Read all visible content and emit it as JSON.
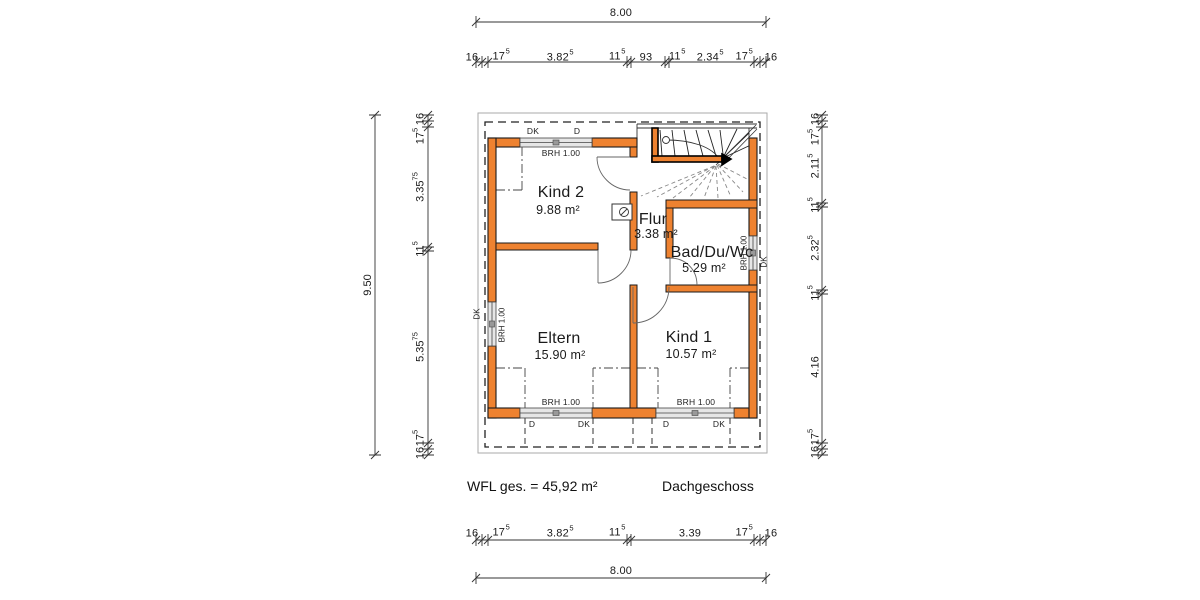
{
  "title": "Dachgeschoss Grundriss",
  "dims": {
    "top_total": "8.00",
    "bottom_total": "8.00",
    "left_total": "9.50",
    "top": [
      {
        "v": "16"
      },
      {
        "v": "17",
        "s": "5"
      },
      {
        "v": "3.82",
        "s": "5"
      },
      {
        "v": "11",
        "s": "5"
      },
      {
        "v": "93"
      },
      {
        "v": "11",
        "s": "5"
      },
      {
        "v": "2.34",
        "s": "5"
      },
      {
        "v": "17",
        "s": "5"
      },
      {
        "v": "16"
      }
    ],
    "bottom": [
      {
        "v": "16"
      },
      {
        "v": "17",
        "s": "5"
      },
      {
        "v": "3.82",
        "s": "5"
      },
      {
        "v": "11",
        "s": "5"
      },
      {
        "v": "3.39"
      },
      {
        "v": "17",
        "s": "5"
      },
      {
        "v": "16"
      }
    ],
    "left": [
      {
        "v": "16"
      },
      {
        "v": "17",
        "s": "5"
      },
      {
        "v": "3.35",
        "s": "75"
      },
      {
        "v": "11",
        "s": "5"
      },
      {
        "v": "5.35",
        "s": "75"
      },
      {
        "v": "17",
        "s": "5"
      },
      {
        "v": "16"
      }
    ],
    "right": [
      {
        "v": "16"
      },
      {
        "v": "17",
        "s": "5"
      },
      {
        "v": "2.11",
        "s": "5"
      },
      {
        "v": "11",
        "s": "5"
      },
      {
        "v": "2.32",
        "s": "5"
      },
      {
        "v": "11",
        "s": "5"
      },
      {
        "v": "4.16"
      },
      {
        "v": "17",
        "s": "5"
      },
      {
        "v": "16"
      }
    ]
  },
  "rooms": {
    "kind2": {
      "name": "Kind 2",
      "area": "9.88 m²"
    },
    "flur": {
      "name": "Flur",
      "area": "3.38 m²"
    },
    "bad": {
      "name": "Bad/Du/Wc",
      "area": "5.29 m²"
    },
    "eltern": {
      "name": "Eltern",
      "area": "15.90 m²"
    },
    "kind1": {
      "name": "Kind 1",
      "area": "10.57 m²"
    }
  },
  "win": {
    "brh": "BRH 1.00",
    "dk": "DK",
    "d": "D"
  },
  "footer": {
    "wfl": "WFL ges. = 45,92 m²",
    "floor": "Dachgeschoss"
  },
  "colors": {
    "wall": "#EE8230",
    "line": "#1a1a1a"
  }
}
